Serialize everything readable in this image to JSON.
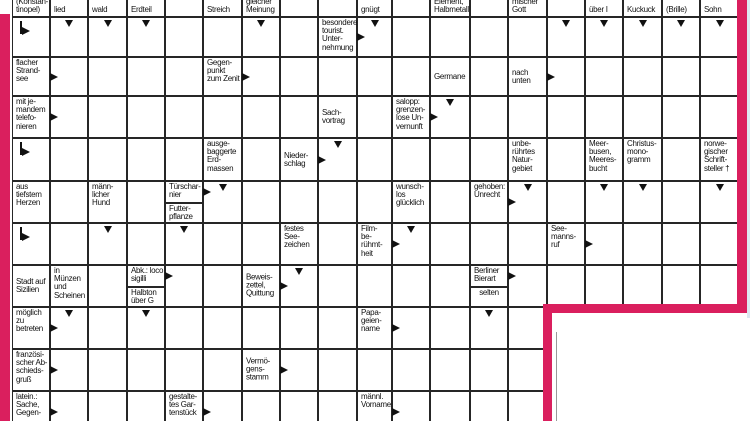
{
  "colors": {
    "pink": "#da1f5e",
    "grid_line": "#262626",
    "cell_bg": "#ffffff",
    "text": "#111111",
    "edge_blue": "#dce7f1",
    "fold_line": "#999999"
  },
  "canvas": {
    "width": 750,
    "height": 421
  },
  "grid": {
    "col_bounds": [
      12,
      50,
      88,
      127,
      165,
      203,
      242,
      280,
      318,
      357,
      392,
      430,
      470,
      508,
      547,
      585,
      623,
      662,
      700,
      740
    ],
    "row_bounds": [
      -25,
      17,
      57,
      96,
      138,
      181,
      223,
      265,
      307,
      349,
      391,
      433
    ],
    "full_rows_until": 7,
    "narrow_rows_cols": 14,
    "clues": [
      {
        "r": 0,
        "c": 1,
        "lines": [
          "(Konstan-",
          "tinopel)"
        ],
        "anchor": "bottom"
      },
      {
        "r": 0,
        "c": 2,
        "lines": [
          "lied"
        ],
        "anchor": "bottom"
      },
      {
        "r": 0,
        "c": 3,
        "lines": [
          "wald"
        ],
        "anchor": "bottom"
      },
      {
        "r": 0,
        "c": 4,
        "lines": [
          "Erdteil"
        ],
        "anchor": "bottom"
      },
      {
        "r": 0,
        "c": 6,
        "lines": [
          "Streich"
        ],
        "anchor": "bottom"
      },
      {
        "r": 0,
        "c": 7,
        "lines": [
          "gleicher",
          "Meinung"
        ],
        "anchor": "bottom"
      },
      {
        "r": 0,
        "c": 10,
        "lines": [
          "gnügt"
        ],
        "anchor": "bottom"
      },
      {
        "r": 0,
        "c": 12,
        "lines": [
          "Element,",
          "Halbmetall"
        ],
        "anchor": "bottom"
      },
      {
        "r": 0,
        "c": 14,
        "lines": [
          "mischer",
          "Gott"
        ],
        "anchor": "bottom"
      },
      {
        "r": 0,
        "c": 16,
        "lines": [
          "über I"
        ],
        "anchor": "bottom"
      },
      {
        "r": 0,
        "c": 17,
        "lines": [
          "Kuckuck"
        ],
        "anchor": "bottom"
      },
      {
        "r": 0,
        "c": 18,
        "lines": [
          "(Brille)"
        ],
        "anchor": "bottom"
      },
      {
        "r": 0,
        "c": 19,
        "lines": [
          "Sohn"
        ],
        "anchor": "bottom"
      },
      {
        "r": 1,
        "c": 9,
        "lines": [
          "besondere",
          "tourist.",
          "Unter-",
          "nehmung"
        ],
        "arrow": "right"
      },
      {
        "r": 2,
        "c": 1,
        "lines": [
          "flacher",
          "Strand-",
          "see"
        ],
        "arrow": "right"
      },
      {
        "r": 2,
        "c": 6,
        "lines": [
          "Gegen-",
          "punkt",
          "zum Zenit"
        ],
        "arrow": "right"
      },
      {
        "r": 2,
        "c": 12,
        "lines": [
          "Germane"
        ],
        "valign": "middle"
      },
      {
        "r": 2,
        "c": 14,
        "lines": [
          "nach",
          "unten"
        ],
        "valign": "middle",
        "arrow": "right"
      },
      {
        "r": 3,
        "c": 1,
        "lines": [
          "mit je-",
          "mandem",
          "telefo-",
          "nieren"
        ],
        "arrow": "right"
      },
      {
        "r": 3,
        "c": 9,
        "lines": [
          "Sach-",
          "vortrag"
        ],
        "valign": "middle"
      },
      {
        "r": 3,
        "c": 11,
        "lines": [
          "salopp:",
          "grenzen-",
          "lose Un-",
          "vernunft"
        ],
        "arrow": "right"
      },
      {
        "r": 4,
        "c": 6,
        "lines": [
          "ausge-",
          "baggerte",
          "Erd-",
          "massen"
        ]
      },
      {
        "r": 4,
        "c": 8,
        "lines": [
          "Nieder-",
          "schlag"
        ],
        "valign": "middle",
        "arrow": "right"
      },
      {
        "r": 4,
        "c": 14,
        "lines": [
          "unbe-",
          "rührtes",
          "Natur-",
          "gebiet"
        ]
      },
      {
        "r": 4,
        "c": 16,
        "lines": [
          "Meer-",
          "busen,",
          "Meeres-",
          "bucht"
        ]
      },
      {
        "r": 4,
        "c": 17,
        "lines": [
          "Christus-",
          "mono-",
          "gramm"
        ]
      },
      {
        "r": 4,
        "c": 19,
        "lines": [
          "norwe-",
          "gischer",
          "Schrift-",
          "steller †"
        ]
      },
      {
        "r": 5,
        "c": 1,
        "lines": [
          "aus",
          "tiefstem",
          "Herzen"
        ]
      },
      {
        "r": 5,
        "c": 3,
        "lines": [
          "männ-",
          "licher",
          "Hund"
        ]
      },
      {
        "r": 5,
        "c": 11,
        "lines": [
          "wunsch-",
          "los",
          "glücklich"
        ]
      },
      {
        "r": 5,
        "c": 13,
        "lines": [
          "gehoben:",
          "Unrecht"
        ],
        "arrow": "right"
      },
      {
        "r": 6,
        "c": 8,
        "lines": [
          "festes",
          "See-",
          "zeichen"
        ]
      },
      {
        "r": 6,
        "c": 10,
        "lines": [
          "Film-",
          "be-",
          "rühmt-",
          "heit"
        ],
        "arrow": "right"
      },
      {
        "r": 6,
        "c": 15,
        "lines": [
          "See-",
          "manns-",
          "ruf"
        ],
        "arrow": "right"
      },
      {
        "r": 7,
        "c": 1,
        "lines": [
          "Stadt auf",
          "Sizilien"
        ],
        "valign": "middle"
      },
      {
        "r": 7,
        "c": 2,
        "lines": [
          "in",
          "Münzen",
          "und",
          "Scheinen"
        ]
      },
      {
        "r": 7,
        "c": 7,
        "lines": [
          "Beweis-",
          "zettel,",
          "Quittung"
        ],
        "valign": "middle",
        "arrow": "right"
      },
      {
        "r": 8,
        "c": 1,
        "lines": [
          "möglich",
          "zu",
          "betreten"
        ],
        "arrow": "right"
      },
      {
        "r": 8,
        "c": 10,
        "lines": [
          "Papa-",
          "geien-",
          "name"
        ],
        "arrow": "right"
      },
      {
        "r": 9,
        "c": 1,
        "lines": [
          "französi-",
          "scher Ab-",
          "schieds-",
          "gruß"
        ],
        "arrow": "right"
      },
      {
        "r": 9,
        "c": 7,
        "lines": [
          "Vermö-",
          "gens-",
          "stamm"
        ],
        "valign": "middle",
        "arrow": "right"
      },
      {
        "r": 10,
        "c": 1,
        "lines": [
          "latein.:",
          "Sache,",
          "Gegen-"
        ],
        "arrow": "right"
      },
      {
        "r": 10,
        "c": 5,
        "lines": [
          "gestalte-",
          "tes Gar-",
          "tenstück"
        ],
        "arrow": "right"
      },
      {
        "r": 10,
        "c": 10,
        "lines": [
          "männl.",
          "Vorname"
        ],
        "arrow": "right"
      }
    ],
    "split_clues": [
      {
        "r": 5,
        "c": 5,
        "top": {
          "lines": [
            "Türschar-",
            "nier"
          ],
          "arrow": "right"
        },
        "bottom": {
          "lines": [
            "Futter-",
            "pflanze"
          ]
        }
      },
      {
        "r": 7,
        "c": 4,
        "top": {
          "lines": [
            "Abk.: loco",
            "sigilli"
          ],
          "arrow": "right"
        },
        "bottom": {
          "lines": [
            "Halbton",
            "über G"
          ]
        }
      },
      {
        "r": 7,
        "c": 13,
        "top": {
          "lines": [
            "Berliner",
            "Bierart"
          ],
          "arrow": "right"
        },
        "bottom": {
          "lines": [
            "selten"
          ],
          "center": true
        }
      }
    ],
    "down_arrows": [
      [
        1,
        2
      ],
      [
        1,
        3
      ],
      [
        1,
        4
      ],
      [
        1,
        7
      ],
      [
        1,
        10
      ],
      [
        1,
        15
      ],
      [
        1,
        16
      ],
      [
        1,
        17
      ],
      [
        1,
        18
      ],
      [
        1,
        19
      ],
      [
        3,
        12
      ],
      [
        4,
        9
      ],
      [
        5,
        6
      ],
      [
        5,
        14
      ],
      [
        5,
        16
      ],
      [
        5,
        17
      ],
      [
        5,
        19
      ],
      [
        6,
        3
      ],
      [
        6,
        5
      ],
      [
        6,
        11
      ],
      [
        7,
        8
      ],
      [
        8,
        2
      ],
      [
        8,
        4
      ],
      [
        8,
        13
      ]
    ],
    "bent_arrows": [
      [
        1,
        1
      ],
      [
        4,
        1
      ],
      [
        6,
        1
      ]
    ]
  },
  "borders": {
    "left": {
      "x": 0,
      "y": 14,
      "w": 10,
      "h": 407
    },
    "right": {
      "x": 737,
      "y": 0,
      "w": 10,
      "h": 313
    },
    "inner_h": {
      "x": 543,
      "y": 304,
      "w": 204,
      "h": 9
    },
    "inner_v": {
      "x": 543,
      "y": 304,
      "w": 9,
      "h": 117
    },
    "blue_strip": {
      "x": 747,
      "y": 0,
      "w": 3,
      "h": 318
    },
    "fold_line": {
      "x": 556,
      "y": 332,
      "w": 1,
      "h": 89
    }
  }
}
